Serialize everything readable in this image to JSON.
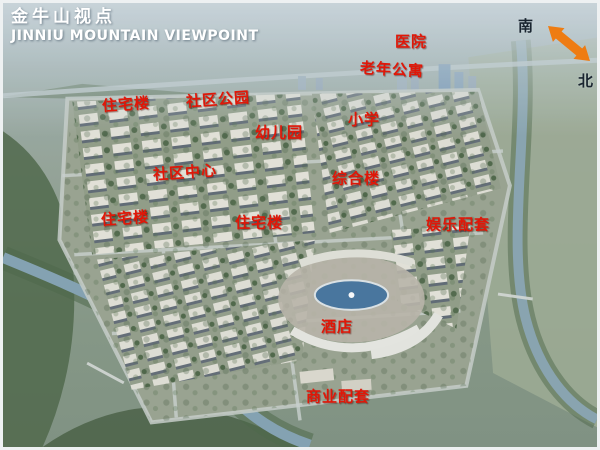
{
  "title": {
    "zh": "金牛山视点",
    "en": "JINNIU MOUNTAIN VIEWPOINT"
  },
  "compass": {
    "south_label": "南",
    "north_label": "北"
  },
  "map_labels": [
    {
      "id": "hospital",
      "text": "医院"
    },
    {
      "id": "elderly-apartments",
      "text": "老年公寓"
    },
    {
      "id": "residential-building-1",
      "text": "住宅楼"
    },
    {
      "id": "community-park",
      "text": "社区公园"
    },
    {
      "id": "kindergarten",
      "text": "幼儿园"
    },
    {
      "id": "primary-school",
      "text": "小学"
    },
    {
      "id": "community-center",
      "text": "社区中心"
    },
    {
      "id": "mixed-use-building",
      "text": "综合楼"
    },
    {
      "id": "residential-building-2",
      "text": "住宅楼"
    },
    {
      "id": "residential-building-3",
      "text": "住宅楼"
    },
    {
      "id": "entertainment-facilities",
      "text": "娱乐配套"
    },
    {
      "id": "hotel",
      "text": "酒店"
    },
    {
      "id": "commercial-facilities",
      "text": "商业配套"
    }
  ],
  "colors": {
    "label_red": "#e01708",
    "compass_orange": "#ee7c12",
    "title_white": "#ffffff"
  }
}
